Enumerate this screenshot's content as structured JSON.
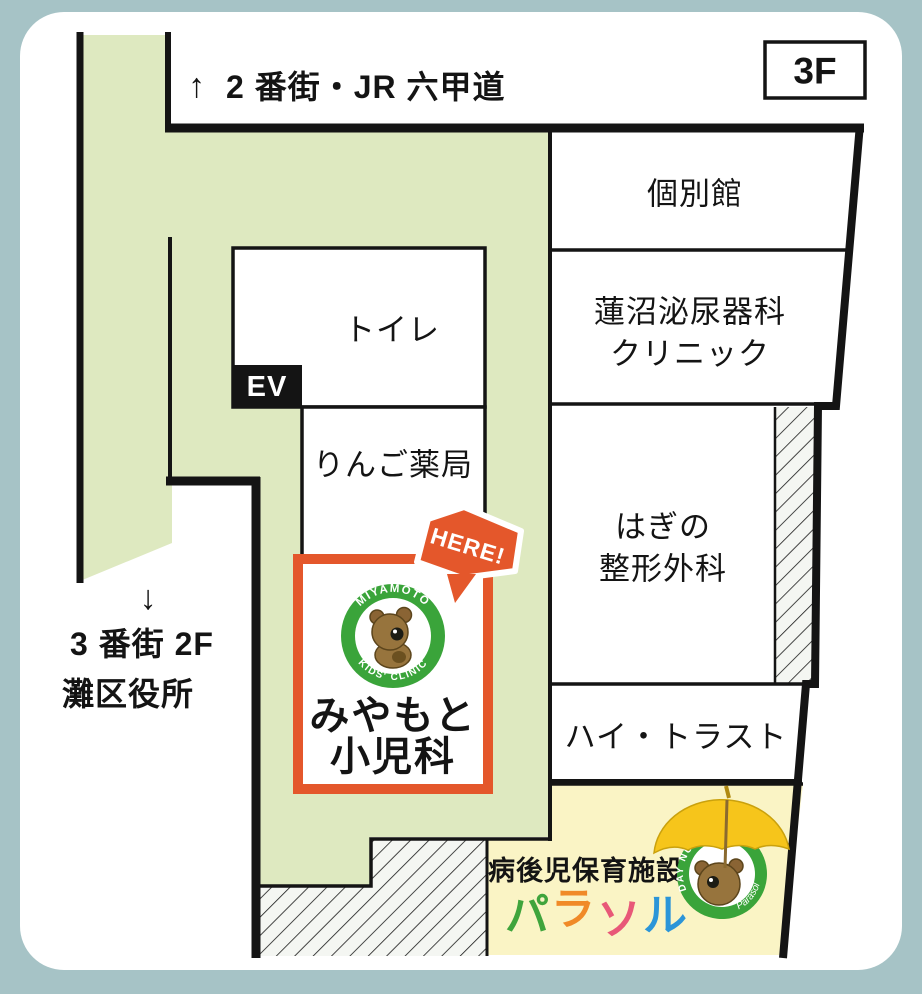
{
  "floor_badge": "3F",
  "directions": {
    "top": {
      "arrow": "↑",
      "label": "2 番街・JR 六甲道"
    },
    "left": {
      "arrow": "↓",
      "line1": "3 番街 2F",
      "line2": "灘区役所"
    }
  },
  "rooms": {
    "kobetsukan": "個別館",
    "hasunuma_line1": "蓮沼泌尿器科",
    "hasunuma_line2": "クリニック",
    "hagino_line1": "はぎの",
    "hagino_line2": "整形外科",
    "hi_trust": "ハイ・トラスト",
    "toilet": "トイレ",
    "elevator": "EV",
    "ringo": "りんご薬局"
  },
  "clinic": {
    "here": "HERE!",
    "logo_arc_top": "MIYAMOTO",
    "logo_arc_bottom": "KIDS' CLINIC",
    "name_line1": "みやもと",
    "name_line2": "小児科"
  },
  "parasol": {
    "subtitle": "病後児保育施設",
    "logo_arc_top": "DAY NURSERY",
    "logo_script": "Parasol",
    "chars": [
      {
        "char": "パ",
        "color": "#3fa43c"
      },
      {
        "char": "ラ",
        "color": "#f08a28"
      },
      {
        "char": "ソ",
        "color": "#e85878"
      },
      {
        "char": "ル",
        "color": "#2b95d8"
      }
    ]
  },
  "colors": {
    "frame": "#a6c3c6",
    "card": "#ffffff",
    "walkway": "#dee9c0",
    "parasol_bg": "#faf4c5",
    "wall": "#141414",
    "accent_orange": "#e4572b",
    "brand_green": "#3aa43a",
    "umbrella_yellow": "#f6c51b",
    "bear_brown": "#97743d"
  }
}
